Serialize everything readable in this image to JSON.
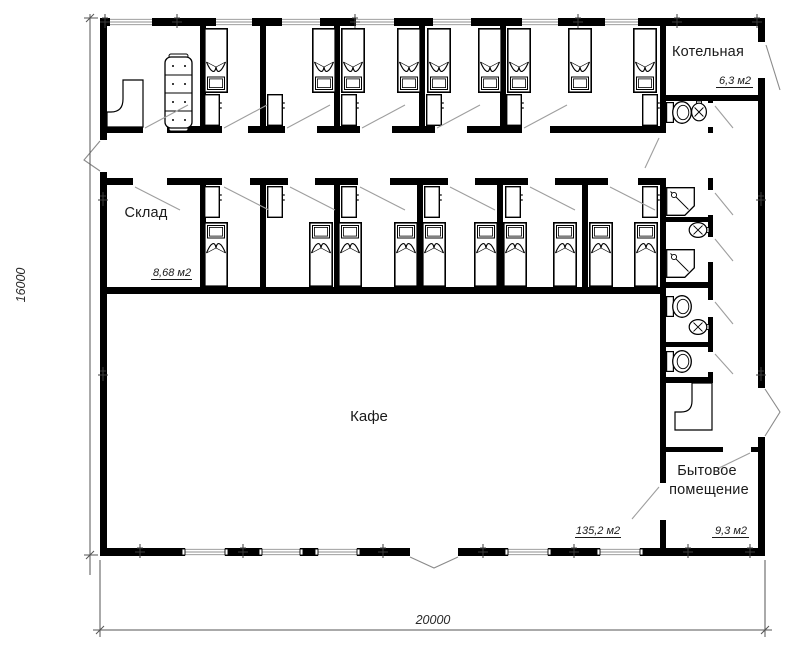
{
  "drawing": {
    "type": "architectural floor plan",
    "rooms": {
      "boiler": {
        "label": "Котельная",
        "area": "6,3 м2"
      },
      "storage": {
        "label": "Склад",
        "area": "8,68 м2"
      },
      "cafe": {
        "label": "Кафе",
        "area": "135,2 м2"
      },
      "utility": {
        "label_line1": "Бытовое",
        "label_line2": "помещение",
        "area": "9,3 м2"
      }
    },
    "dimensions": {
      "height_mm": "16000",
      "width_mm": "20000"
    },
    "colors": {
      "wall": "#000000",
      "furniture_line": "#000000",
      "door_leader_line": "#9e9e9e",
      "dimension_line": "#555555",
      "background": "#ffffff",
      "text": "#1a1a1a"
    },
    "fixtures": {
      "beds": 19,
      "wardrobes": 12,
      "toilets": 3,
      "sinks": 3,
      "showers": 2,
      "sofas": 1,
      "reception_desks": 2
    }
  }
}
